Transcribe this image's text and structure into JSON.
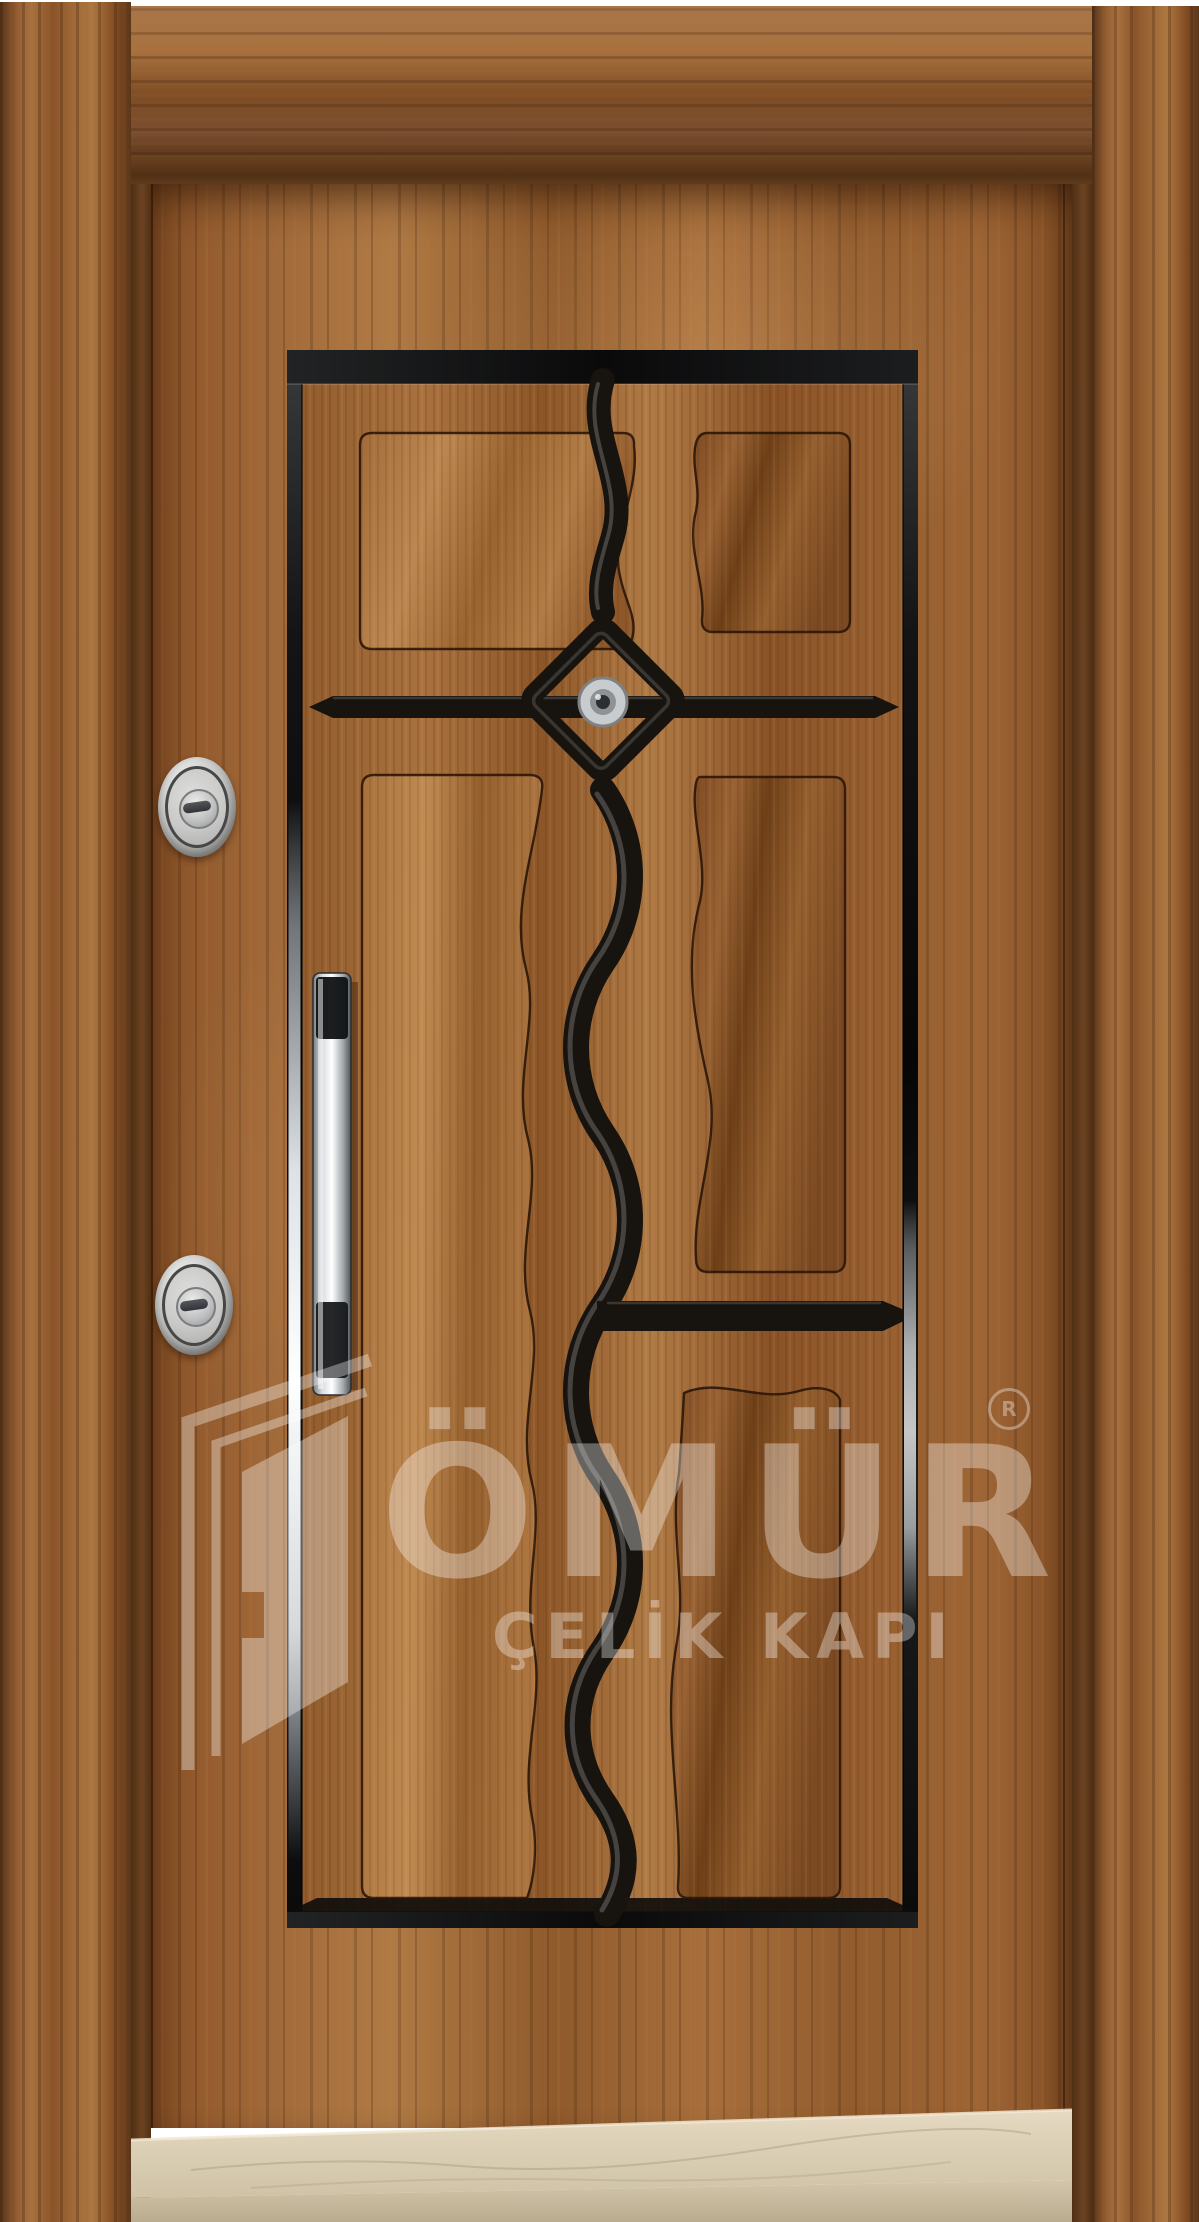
{
  "meta": {
    "type": "product-photo",
    "subject": "steel entry door with walnut wood finish, black glossy panel moldings, wavy center strip, diamond peephole ornament, twin cylinder locks, vertical chrome pull handle, marble threshold"
  },
  "watermark": {
    "brand": "ÖMÜR",
    "tagline": "ÇELİK KAPI",
    "registered_symbol_letter": "R",
    "color": "#ffffff"
  },
  "door": {
    "colors": {
      "background": "#ffffff",
      "casing_wood": "#8d5830",
      "jamb_wood": "#5e3a1e",
      "leaf_wood": "#9c6434",
      "panel_trim_black": "#17130f",
      "chrome": "#e8ecee",
      "lock_silver": "#c9c9c7",
      "marble_top": "#d8ccb2",
      "marble_front": "#c8bb9e"
    },
    "features": {
      "peephole": "silver peephole centered in black diamond ornament",
      "locks": [
        "upper cylinder lock",
        "lower cylinder lock"
      ],
      "handle": "vertical chrome pull handle with dark grip sections",
      "threshold": "beige marble step"
    }
  }
}
